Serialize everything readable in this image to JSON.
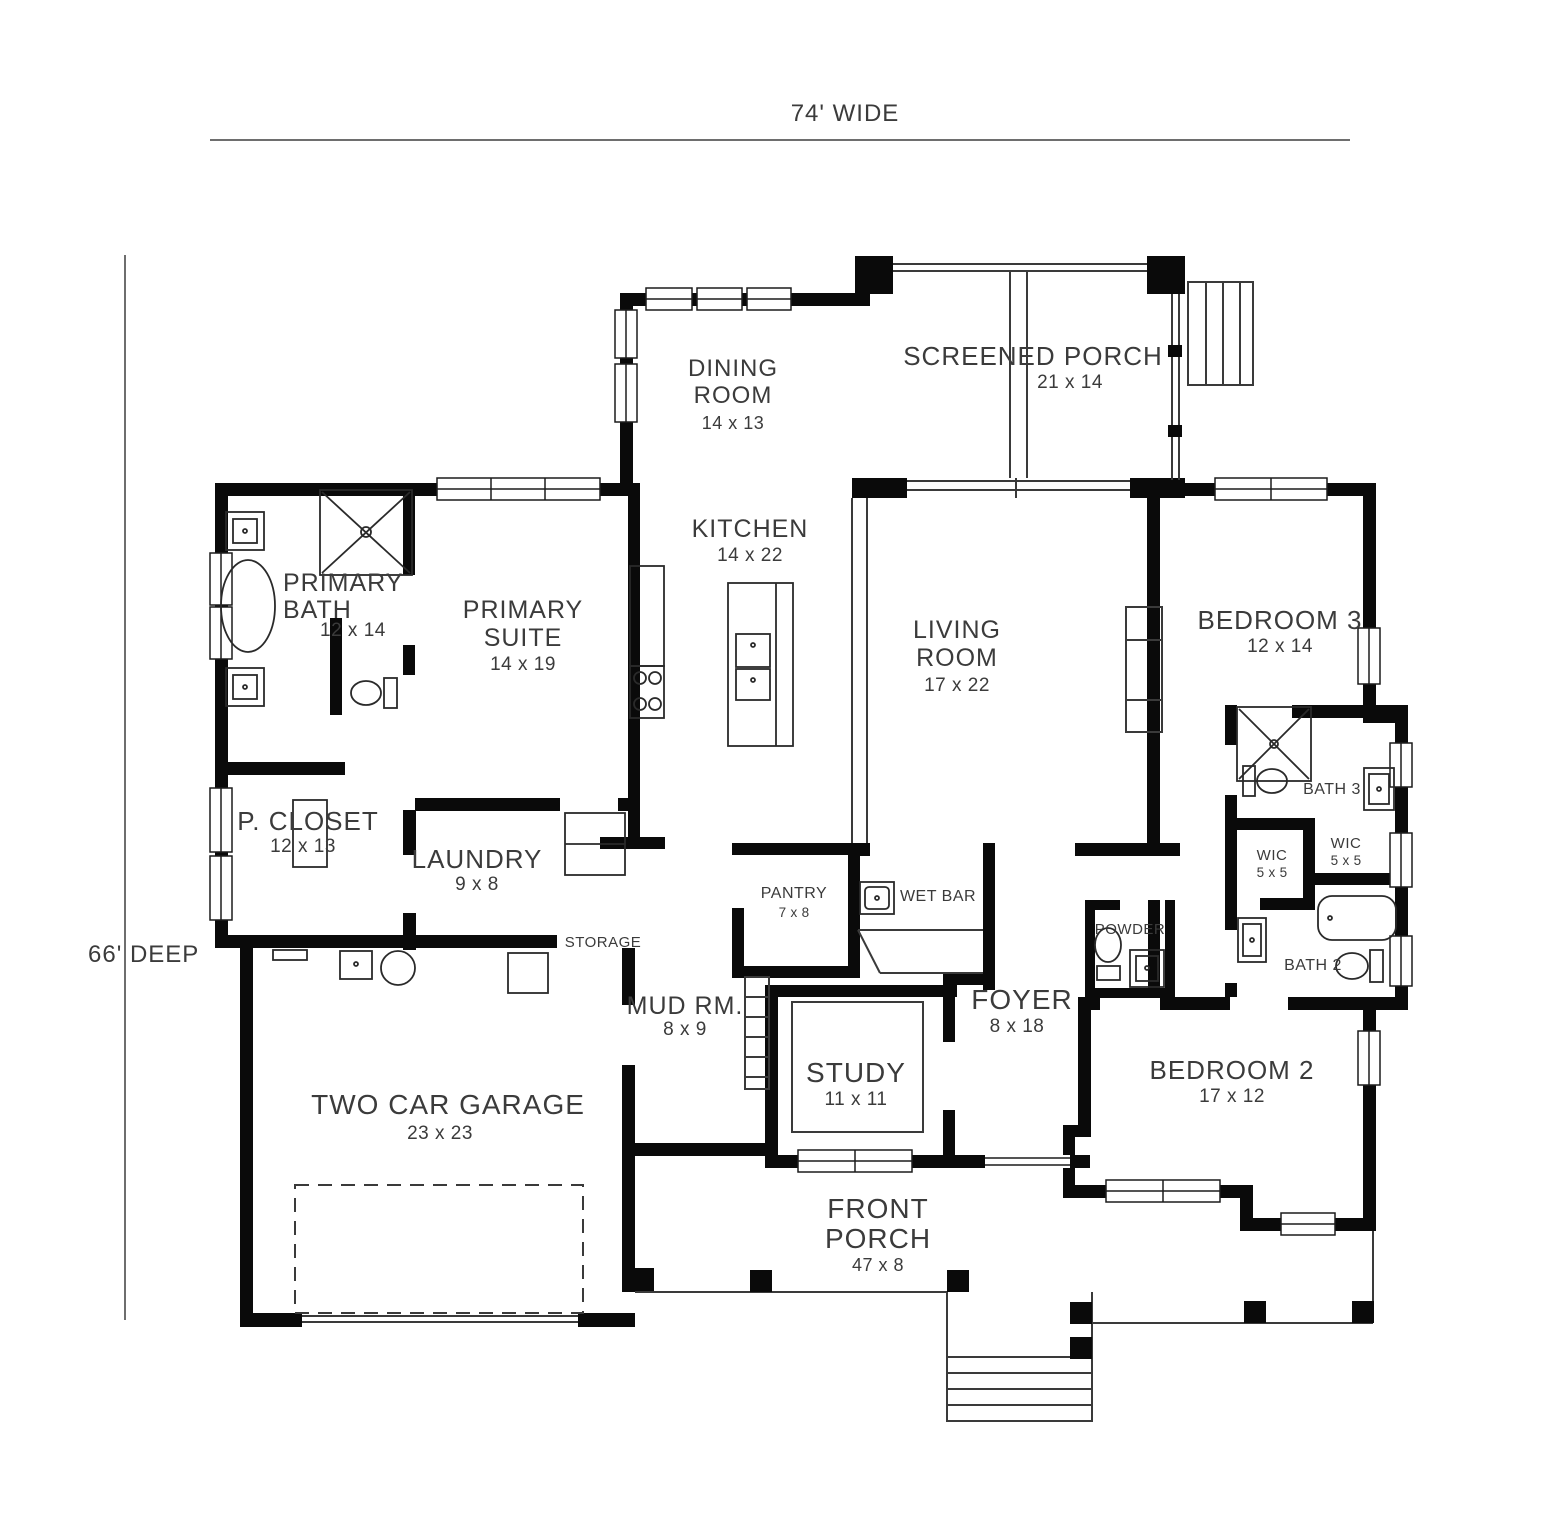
{
  "dimension_labels": {
    "width": "74' WIDE",
    "depth": "66' DEEP"
  },
  "colors": {
    "wall": "#0a0a0a",
    "thin_line": "#3a3a3a",
    "text": "#3b3b3b",
    "dimension_line": "#6e6e6e",
    "background": "#ffffff"
  },
  "rooms": {
    "dining": {
      "line1": "DINING",
      "line2": "ROOM",
      "dims": "14 x 13"
    },
    "screened_porch": {
      "line1": "SCREENED PORCH",
      "dims": "21 x 14"
    },
    "kitchen": {
      "line1": "KITCHEN",
      "dims": "14 x 22"
    },
    "living": {
      "line1": "LIVING",
      "line2": "ROOM",
      "dims": "17 x 22"
    },
    "primary_bath": {
      "line1": "PRIMARY",
      "line2": "BATH",
      "dims": "12 x 14"
    },
    "primary_suite": {
      "line1": "PRIMARY",
      "line2": "SUITE",
      "dims": "14 x 19"
    },
    "bedroom3": {
      "line1": "BEDROOM 3",
      "dims": "12 x 14"
    },
    "p_closet": {
      "line1": "P. CLOSET",
      "dims": "12 x 13"
    },
    "laundry": {
      "line1": "LAUNDRY",
      "dims": "9 x 8"
    },
    "pantry": {
      "line1": "PANTRY",
      "dims": "7 x 8"
    },
    "wet_bar": {
      "line1": "WET BAR"
    },
    "storage": {
      "line1": "STORAGE"
    },
    "mud_room": {
      "line1": "MUD RM.",
      "dims": "8 x 9"
    },
    "foyer": {
      "line1": "FOYER",
      "dims": "8 x 18"
    },
    "study": {
      "line1": "STUDY",
      "dims": "11 x 11"
    },
    "powder": {
      "line1": "POWDER"
    },
    "bath3": {
      "line1": "BATH 3"
    },
    "wic_upper": {
      "line1": "WIC",
      "dims": "5 x 5"
    },
    "wic_lower": {
      "line1": "WIC",
      "dims": "5 x 5"
    },
    "bath2": {
      "line1": "BATH 2"
    },
    "bedroom2": {
      "line1": "BEDROOM 2",
      "dims": "17 x 12"
    },
    "garage": {
      "line1": "TWO CAR GARAGE",
      "dims": "23 x 23"
    },
    "front_porch": {
      "line1": "FRONT",
      "line2": "PORCH",
      "dims": "47 x 8"
    }
  }
}
